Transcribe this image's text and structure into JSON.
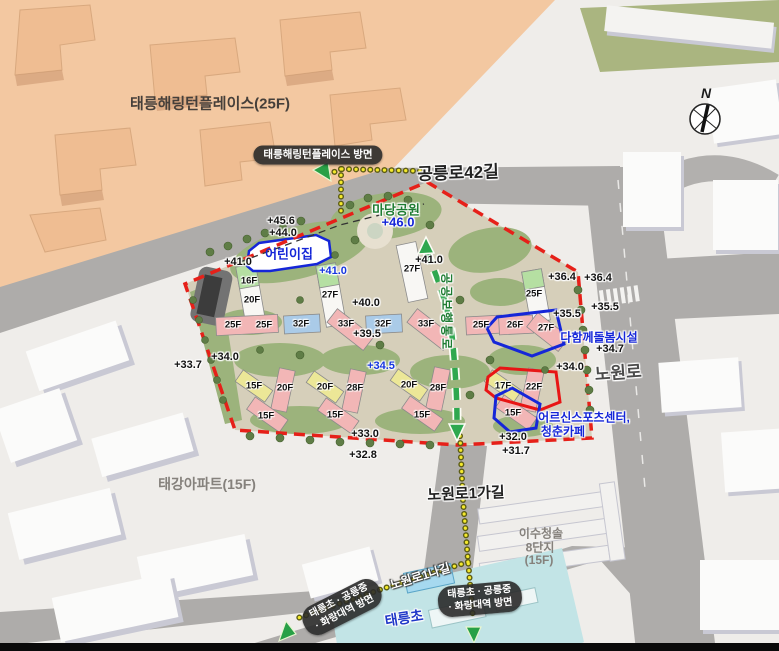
{
  "labels": {
    "harrington": "태릉해링턴플레이스(25F)",
    "gongneungro42": "공릉로42길",
    "nowonro": "노원로",
    "nowonro1ga": "노원로1가길",
    "nowonro1na": "노원로1나길",
    "taegang_apt": "태강아파트(15F)",
    "isu_line1": "이수청솔",
    "isu_line2": "8단지",
    "isu_line3": "(15F)",
    "taereung_elementary": "태릉초",
    "madang_park": "마당공원",
    "madang_park_elev": "+46.0",
    "daycare": "어린이집",
    "care_center": "다함께돌봄시설",
    "senior_line1": "어르신스포츠센터,",
    "senior_line2": "청춘카페",
    "public_walkway": "공공보행통로",
    "compass_n": "N"
  },
  "badges": {
    "top_direction": "태릉해링턴플레이스 방면",
    "left_line1": "태릉초 · 공릉중",
    "left_line2": "· 화랑대역 방면",
    "right_line1": "태릉초 · 공릉중",
    "right_line2": "· 화랑대역 방면"
  },
  "elevation_markers": [
    {
      "text": "+45.6",
      "x": 281,
      "y": 221,
      "color": "dark"
    },
    {
      "text": "+44.0",
      "x": 283,
      "y": 233,
      "color": "dark"
    },
    {
      "text": "+41.0",
      "x": 238,
      "y": 262,
      "color": "dark"
    },
    {
      "text": "+41.0",
      "x": 333,
      "y": 271,
      "color": "blue"
    },
    {
      "text": "+41.0",
      "x": 429,
      "y": 260,
      "color": "dark"
    },
    {
      "text": "+40.0",
      "x": 366,
      "y": 303,
      "color": "dark"
    },
    {
      "text": "+39.5",
      "x": 367,
      "y": 334,
      "color": "dark"
    },
    {
      "text": "+34.0",
      "x": 225,
      "y": 357,
      "color": "dark"
    },
    {
      "text": "+33.7",
      "x": 188,
      "y": 365,
      "color": "dark"
    },
    {
      "text": "+34.5",
      "x": 381,
      "y": 366,
      "color": "blue"
    },
    {
      "text": "+33.0",
      "x": 365,
      "y": 434,
      "color": "dark"
    },
    {
      "text": "+32.8",
      "x": 363,
      "y": 455,
      "color": "dark"
    },
    {
      "text": "+32.0",
      "x": 513,
      "y": 437,
      "color": "dark"
    },
    {
      "text": "+31.7",
      "x": 516,
      "y": 451,
      "color": "dark"
    },
    {
      "text": "+34.0",
      "x": 570,
      "y": 367,
      "color": "dark"
    },
    {
      "text": "+34.7",
      "x": 610,
      "y": 349,
      "color": "dark"
    },
    {
      "text": "+35.5",
      "x": 567,
      "y": 314,
      "color": "dark"
    },
    {
      "text": "+35.5",
      "x": 605,
      "y": 307,
      "color": "dark"
    },
    {
      "text": "+36.4",
      "x": 562,
      "y": 277,
      "color": "dark"
    },
    {
      "text": "+36.4",
      "x": 598,
      "y": 278,
      "color": "dark"
    }
  ],
  "building_labels": [
    {
      "text": "16F",
      "x": 249,
      "y": 281
    },
    {
      "text": "20F",
      "x": 252,
      "y": 300
    },
    {
      "text": "25F",
      "x": 233,
      "y": 325
    },
    {
      "text": "25F",
      "x": 264,
      "y": 325
    },
    {
      "text": "27F",
      "x": 330,
      "y": 295
    },
    {
      "text": "32F",
      "x": 301,
      "y": 324
    },
    {
      "text": "33F",
      "x": 346,
      "y": 324
    },
    {
      "text": "32F",
      "x": 383,
      "y": 324
    },
    {
      "text": "27F",
      "x": 412,
      "y": 269
    },
    {
      "text": "33F",
      "x": 426,
      "y": 324
    },
    {
      "text": "25F",
      "x": 481,
      "y": 325
    },
    {
      "text": "25F",
      "x": 534,
      "y": 294
    },
    {
      "text": "26F",
      "x": 515,
      "y": 325
    },
    {
      "text": "27F",
      "x": 546,
      "y": 328
    },
    {
      "text": "15F",
      "x": 254,
      "y": 386
    },
    {
      "text": "20F",
      "x": 285,
      "y": 388
    },
    {
      "text": "15F",
      "x": 266,
      "y": 416
    },
    {
      "text": "20F",
      "x": 325,
      "y": 387
    },
    {
      "text": "28F",
      "x": 355,
      "y": 388
    },
    {
      "text": "15F",
      "x": 335,
      "y": 415
    },
    {
      "text": "20F",
      "x": 409,
      "y": 385
    },
    {
      "text": "28F",
      "x": 438,
      "y": 388
    },
    {
      "text": "15F",
      "x": 422,
      "y": 415
    },
    {
      "text": "17F",
      "x": 503,
      "y": 386
    },
    {
      "text": "22F",
      "x": 534,
      "y": 387
    },
    {
      "text": "15F",
      "x": 513,
      "y": 413
    }
  ],
  "colors": {
    "boundary_red": "#e62019",
    "callout_blue": "#1526d8",
    "walkway_green": "#2fa84f",
    "route_yellow": "#f4e92c",
    "orange_block": "#f3c8a1",
    "park_green": "#9cb37c",
    "school_cyan": "#c2e4e6"
  }
}
